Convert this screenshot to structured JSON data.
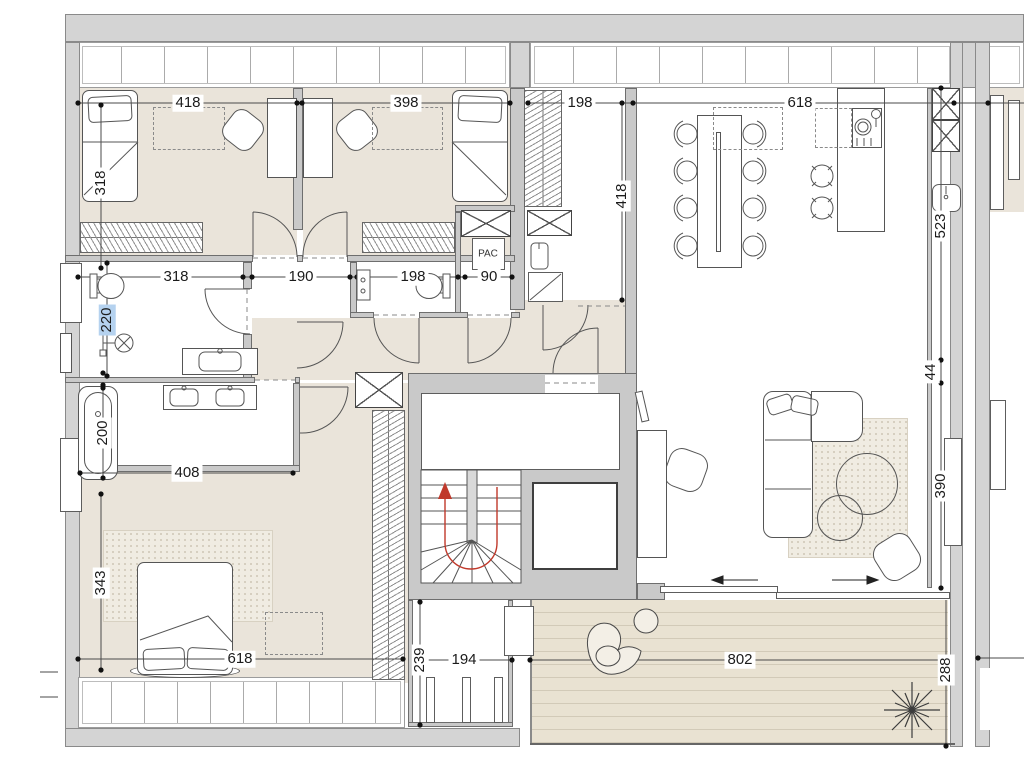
{
  "labels": {
    "pac": "PAC"
  },
  "dims": [
    {
      "label": "418"
    },
    {
      "label": "398"
    },
    {
      "label": "198"
    },
    {
      "label": "618"
    },
    {
      "label": "318"
    },
    {
      "label": "318"
    },
    {
      "label": "190"
    },
    {
      "label": "198"
    },
    {
      "label": "90"
    },
    {
      "label": "220",
      "highlighted": true
    },
    {
      "label": "200"
    },
    {
      "label": "408"
    },
    {
      "label": "343"
    },
    {
      "label": "618"
    },
    {
      "label": "418"
    },
    {
      "label": "239"
    },
    {
      "label": "194"
    },
    {
      "label": "802"
    },
    {
      "label": "288"
    },
    {
      "label": "523"
    },
    {
      "label": "44"
    },
    {
      "label": "390"
    }
  ],
  "colors": {
    "wall": "#d4d4d4",
    "floor_beige": "#eae4da",
    "terrace": "#e9e2d2",
    "stair_arrow": "#c0392b",
    "dim_highlight": "#b5d2ef"
  }
}
